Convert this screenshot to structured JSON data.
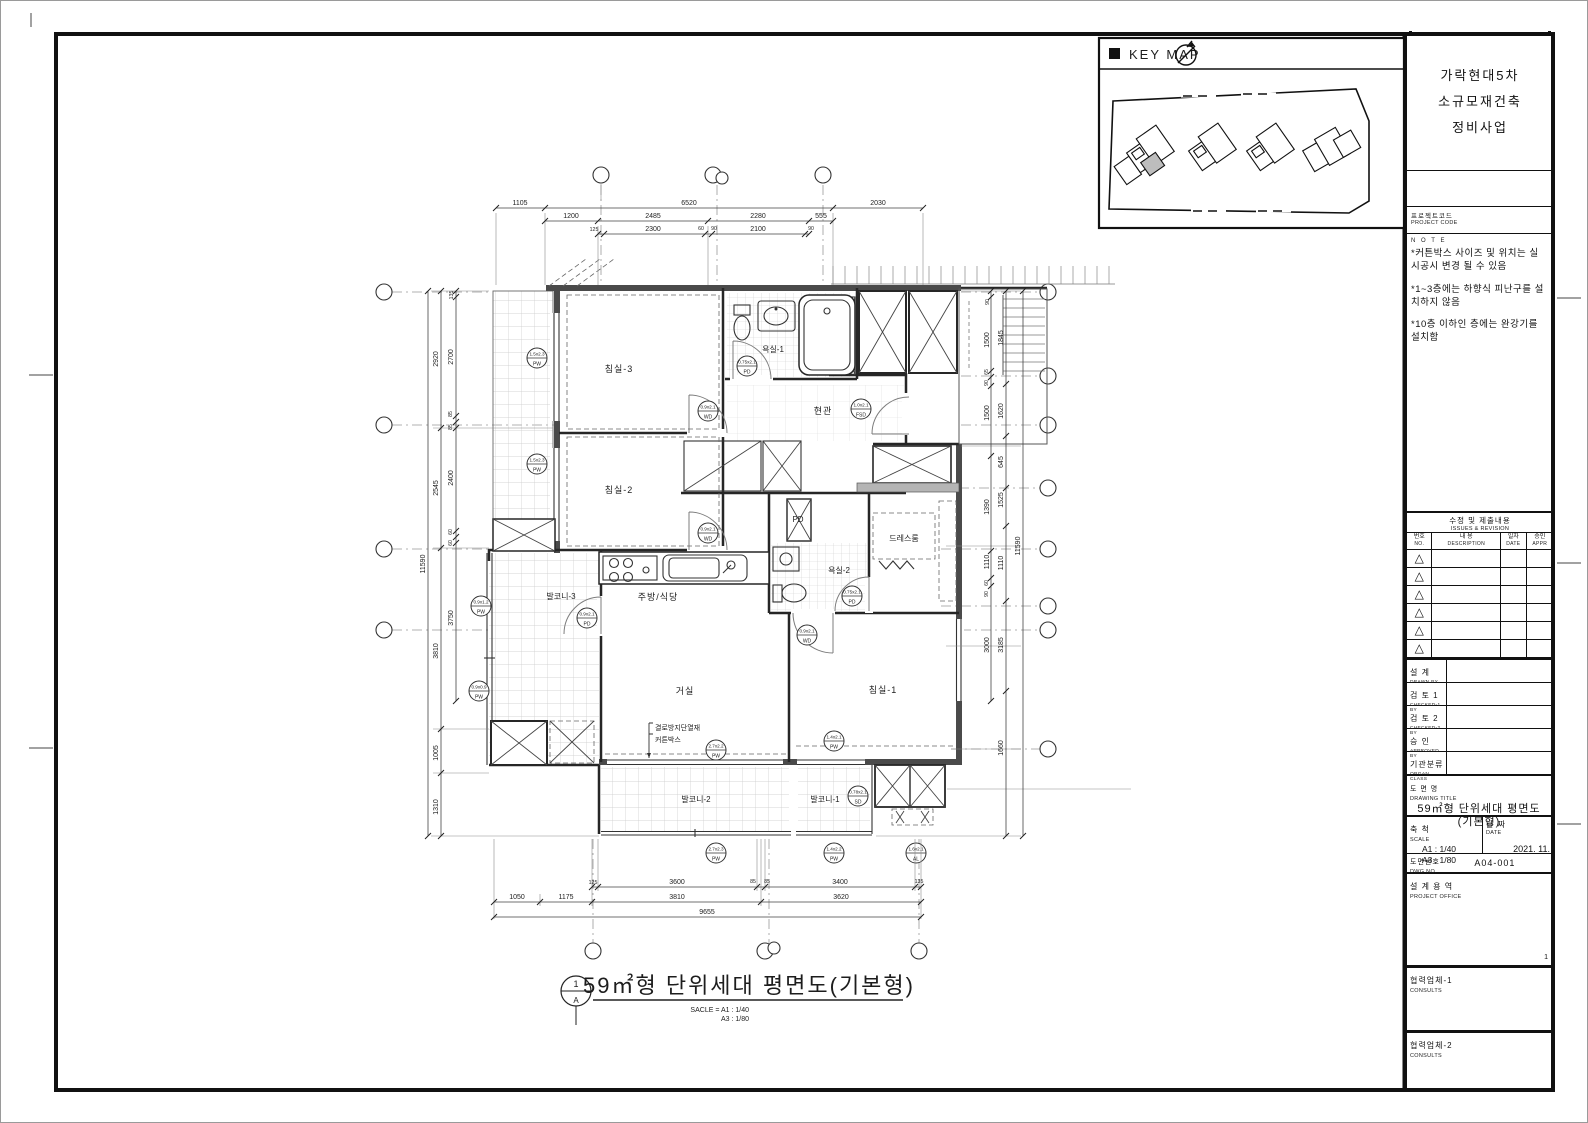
{
  "keymap": {
    "label": "KEY MAP"
  },
  "caption": {
    "num": "1",
    "ref": "A",
    "title": "59㎡형 단위세대 평면도(기본형)",
    "scale1": "SACLE = A1 : 1/40",
    "scale2": "A3 : 1/80"
  },
  "plan": {
    "rooms": {
      "bedroom3": "침실-3",
      "bedroom2": "침실-2",
      "bedroom1": "침실-1",
      "bath1": "욕실-1",
      "bath2": "욕실-2",
      "entrance": "현관",
      "dress": "드레스룸",
      "kitchen": "주방/식당",
      "living": "거실",
      "balcony1": "발코니-1",
      "balcony2": "발코니-2",
      "balcony3": "발코니-3",
      "pd1": "PD",
      "pd2": "PD"
    },
    "annotations": {
      "insulation": "결로방지단열재",
      "curtain": "커튼박스"
    },
    "dims": {
      "top": [
        "1105",
        "6520",
        "2030",
        "1200",
        "2485",
        "2280",
        "555",
        "125",
        "2300",
        "60",
        "90",
        "2100",
        "90"
      ],
      "bottom": [
        "125",
        "3600",
        "85",
        "85",
        "3400",
        "135",
        "1050",
        "1175",
        "3810",
        "3620",
        "9655"
      ],
      "left": [
        "11590",
        "2920",
        "2545",
        "3810",
        "1005",
        "1310",
        "135",
        "2700",
        "85",
        "85",
        "2400",
        "60",
        "60",
        "3750"
      ],
      "right": [
        "11590",
        "1845",
        "1620",
        "645",
        "1525",
        "1110",
        "3185",
        "1660",
        "90",
        "1500",
        "65",
        "90",
        "1500",
        "1390",
        "1110",
        "60",
        "90",
        "3000"
      ]
    },
    "tags": [
      {
        "s": "1.5x2.3",
        "t": "PW"
      },
      {
        "s": "1.5x2.3",
        "t": "PW"
      },
      {
        "s": "0.9x2.1",
        "t": "WD"
      },
      {
        "s": "0.9x2.1",
        "t": "WD"
      },
      {
        "s": "0.75x2.1",
        "t": "PD"
      },
      {
        "s": "1.0x2.1",
        "t": "FSD"
      },
      {
        "s": "0.9x2.1",
        "t": "PD"
      },
      {
        "s": "0.75x2.1",
        "t": "PD"
      },
      {
        "s": "0.9x2.1",
        "t": "WD"
      },
      {
        "s": "2.7x2.2",
        "t": "PW"
      },
      {
        "s": "1.4x2.1",
        "t": "PW"
      },
      {
        "s": "2.7x2.3",
        "t": "PW"
      },
      {
        "s": "1.4x2.2",
        "t": "PW"
      },
      {
        "s": "1.6x2.1",
        "t": "AL"
      },
      {
        "s": "0.9x1.2",
        "t": "PW"
      },
      {
        "s": "0.9x0.9",
        "t": "PW"
      },
      {
        "s": "0.78x2.1",
        "t": "SD"
      }
    ]
  },
  "titleblock": {
    "project_name": [
      "가락현대5차",
      "소규모재건축",
      "정비사업"
    ],
    "project_code_ko": "프로젝트코드",
    "project_code_en": "PROJECT CODE",
    "note_label": "N O T E",
    "notes": [
      "*커튼박스 사이즈 및 위치는 실 시공시 변경 될 수 있음",
      "*1~3층에는 하향식 피난구를 설치하지 않음",
      "*10층 이하인 층에는 완강기를 설치함"
    ],
    "rev": {
      "ko": "수정 및 제출내용",
      "en": "ISSUES & REVISION",
      "no_ko": "번호",
      "no_en": "NO.",
      "desc_ko": "내  용",
      "desc_en": "DESCRIPTION",
      "date_ko": "일자",
      "date_en": "DATE",
      "appr_ko": "승인",
      "appr_en": "APPR"
    },
    "signoff": [
      {
        "ko": "설  계",
        "en": "DRAWN BY"
      },
      {
        "ko": "검 토 1",
        "en": "CHECKED-1 BY"
      },
      {
        "ko": "검 토 2",
        "en": "CHECKED-2 BY"
      },
      {
        "ko": "승  인",
        "en": "APPROVED BY"
      },
      {
        "ko": "기관분류",
        "en": "ORGAN CLASS"
      }
    ],
    "title_label_ko": "도 면 명",
    "title_label_en": "DRAWING TITLE",
    "title_line1": "59㎡형 단위세대 평면도",
    "title_line2": "(기본형)",
    "scale_ko": "축 척",
    "scale_en": "SCALE",
    "scale_a1": "A1 :  1/40",
    "scale_a3": "A3 :  1/80",
    "date_ko": "날 짜",
    "date_en": "DATE",
    "date_val": "2021. 11.",
    "dwg_ko": "도면번호",
    "dwg_en": "DWG NO.",
    "dwg_val": "A04-001",
    "office_ko": "설 계 용 역",
    "office_en": "PROJECT OFFICE",
    "office_num": "1",
    "consult1_ko": "협력업체-1",
    "consult1_en": "CONSULTS",
    "consult2_ko": "협력업체-2",
    "consult2_en": "CONSULTS"
  }
}
